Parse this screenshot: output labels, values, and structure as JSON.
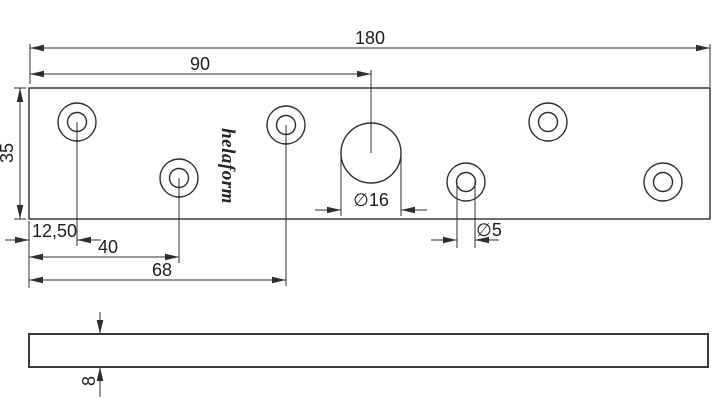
{
  "drawing": {
    "brand": "helaform",
    "front_view": {
      "overall_length_label": "180",
      "center_hole_position_label": "90",
      "plate_width_label": "35",
      "first_hole_offset_label": "12,50",
      "second_hole_offset_label": "40",
      "third_hole_offset_label": "68",
      "center_hole_diameter_label": "∅16",
      "small_hole_diameter_label": "∅5"
    },
    "side_view": {
      "thickness_label": "8"
    },
    "colors": {
      "line": "#2e2e2e",
      "background": "#ffffff"
    }
  }
}
